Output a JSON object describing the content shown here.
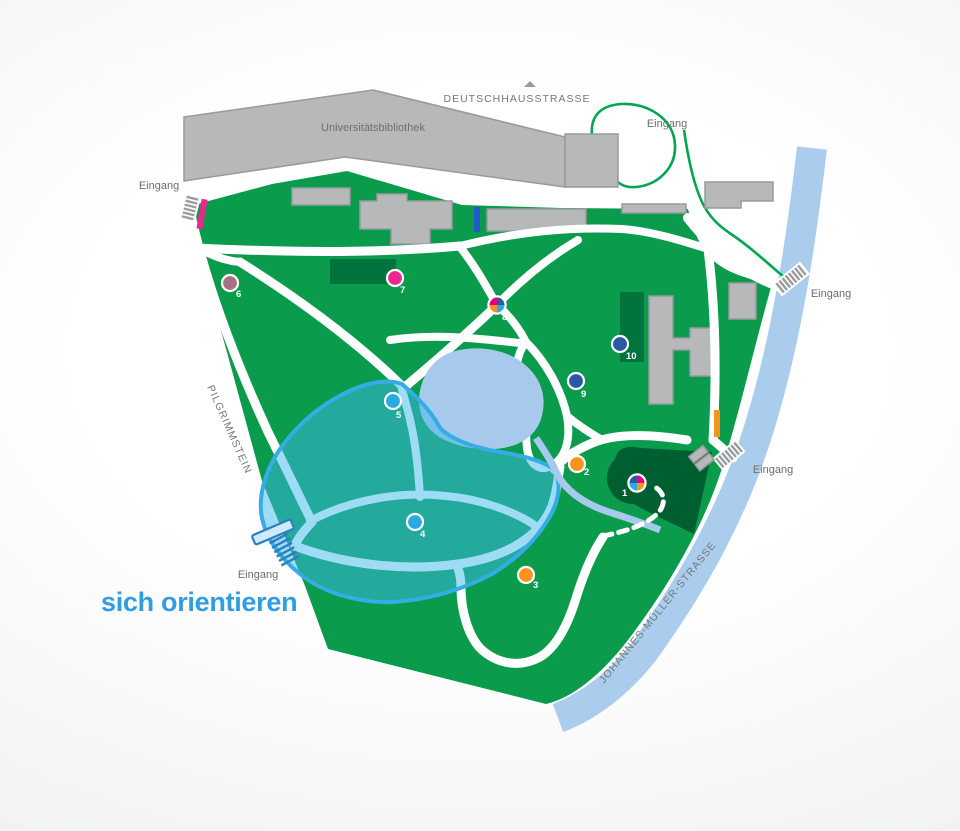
{
  "title": {
    "text": "sich orientieren",
    "color": "#2f9ee0"
  },
  "streets": {
    "top": "DEUTSCHHAUSSTRASSE",
    "left": "PILGRIMMSTEIN",
    "right": "JOHANNES-MÜLLER-STRASSE"
  },
  "building_label": "Universitätsbibliothek",
  "entrances": {
    "top_left": "Eingang",
    "top": "Eingang",
    "right_upper": "Eingang",
    "right_lower": "Eingang",
    "bottom_left": "Eingang"
  },
  "palette": {
    "park_green": "#0a9b4c",
    "dark_green": "#00743c",
    "darkest_green": "#005f30",
    "lake_blue": "#a7c9eb",
    "river_blue": "#aacdee",
    "route_green": "#00a651",
    "region_fill": "rgba(62,185,235,0.5)",
    "region_border": "#36ace5",
    "title_blue": "#2f9ee0",
    "bar_pink": "#ec268f",
    "bar_blue": "#2358c8",
    "bar_orange": "#f7941d"
  },
  "markers": [
    {
      "label": "1",
      "type": "multi",
      "colors": [
        "#2b57a7",
        "#e6007e",
        "#f7941d",
        "#29abe2"
      ]
    },
    {
      "label": "2",
      "color": "#f7941d"
    },
    {
      "label": "3",
      "color": "#f7941d"
    },
    {
      "label": "4",
      "color": "#29abe2"
    },
    {
      "label": "5",
      "color": "#29abe2"
    },
    {
      "label": "6",
      "color": "#a87182"
    },
    {
      "label": "7",
      "color": "#ec268f"
    },
    {
      "label": "8",
      "type": "multi",
      "colors": [
        "#e6007e",
        "#2b57a7",
        "#29abe2",
        "#f7941d"
      ]
    },
    {
      "label": "9",
      "color": "#2b57a7"
    },
    {
      "label": "10",
      "color": "#2b57a7"
    }
  ]
}
